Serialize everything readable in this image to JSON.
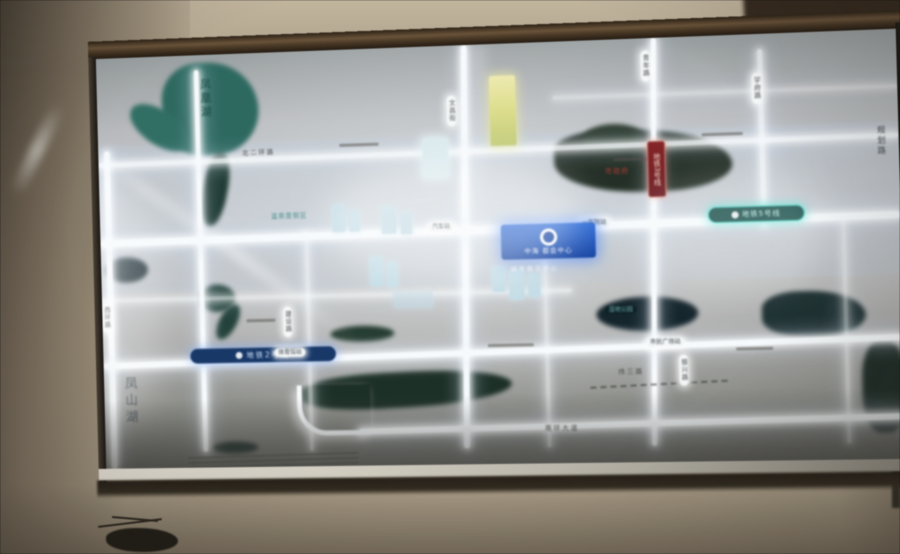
{
  "map": {
    "project": {
      "name": "中海 都会中心",
      "subtext": "城市展示中心"
    },
    "metro": {
      "line5_badge": "地铁5号线",
      "line2_badge": "地铁2号线",
      "line3_badge": "地铁3号线"
    },
    "stations": [
      "汽车站",
      "一医院站",
      "体育馆站",
      "市民广场站"
    ],
    "road_labels_vertical": [
      "文昌街",
      "青年路",
      "学府路",
      "振兴路",
      "西环路",
      "建设路"
    ],
    "road_labels_horizontal": [
      "北二环路",
      "南环大道",
      "纬三路"
    ],
    "area_labels": {
      "lake_nw": "凤凰湖",
      "district_sw": "凤山湖",
      "resort": "温泉度假区",
      "wetland": "湿地公园",
      "gov": "市政府",
      "right_edge": "规划路"
    },
    "colors": {
      "metro5_teal": "#2fb5a8",
      "metro2_blue": "#1d4e8f",
      "line3_red": "#8a2a2c",
      "project_blue": "#1b56c0",
      "landmark_yellow": "#dfe08a",
      "water_teal": "#2a6a60",
      "park_green": "#22352a",
      "road_glow": "#f5f9fb"
    }
  }
}
